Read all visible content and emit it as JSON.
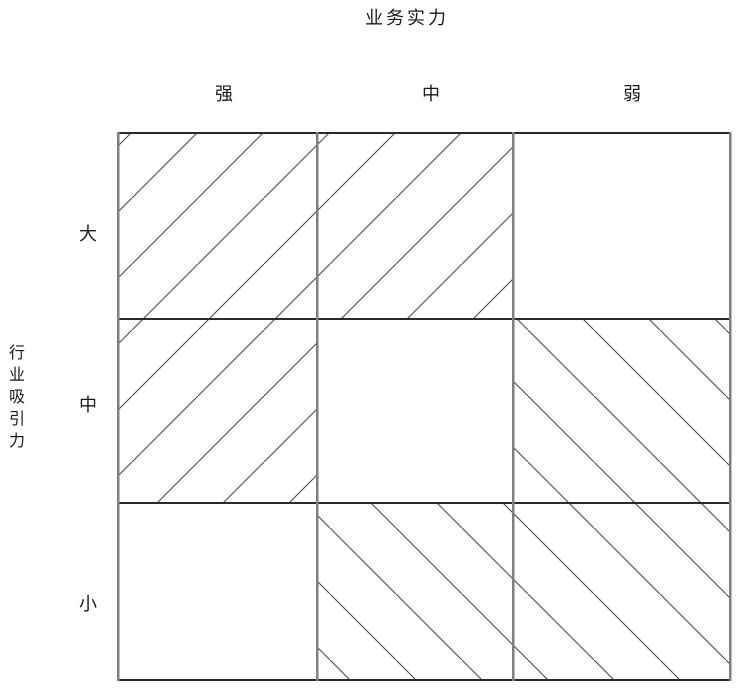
{
  "matrix": {
    "x_axis": {
      "label": "业务实力",
      "categories": [
        "强",
        "中",
        "弱"
      ]
    },
    "y_axis": {
      "label": "行业吸引力",
      "categories": [
        "大",
        "中",
        "小"
      ]
    },
    "cells": [
      {
        "row": "大",
        "col": "强",
        "hatch": "forward"
      },
      {
        "row": "大",
        "col": "中",
        "hatch": "forward"
      },
      {
        "row": "大",
        "col": "弱",
        "hatch": "none"
      },
      {
        "row": "中",
        "col": "强",
        "hatch": "forward"
      },
      {
        "row": "中",
        "col": "中",
        "hatch": "none"
      },
      {
        "row": "中",
        "col": "弱",
        "hatch": "backward"
      },
      {
        "row": "小",
        "col": "强",
        "hatch": "none"
      },
      {
        "row": "小",
        "col": "中",
        "hatch": "backward"
      },
      {
        "row": "小",
        "col": "弱",
        "hatch": "backward"
      }
    ]
  },
  "colors": {
    "background": "#ffffff",
    "grid_vertical": "#7f7f7f",
    "grid_horizontal": "#2a2a2a",
    "hatch": "#4a4a4a",
    "text": "#1a1a1a"
  }
}
